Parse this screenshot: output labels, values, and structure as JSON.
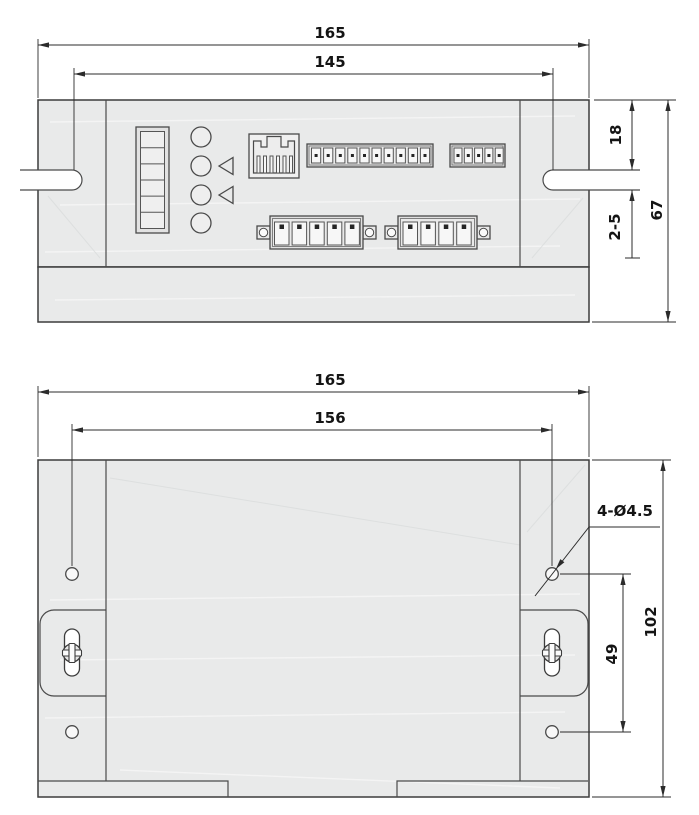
{
  "front_view": {
    "dims": {
      "overall_width": "165",
      "slot_spacing": "145",
      "top_to_slot": "18",
      "panel_thickness": "2-5",
      "overall_height": "67"
    },
    "components": {
      "dip_switch_positions": 6,
      "led_count": 4,
      "indicator_arrows": 2,
      "rj45_port": "RJ45 communication port",
      "terminal_rows_top_positions": [
        10,
        5
      ],
      "terminal_rows_bottom_positions": [
        5,
        4
      ]
    }
  },
  "top_view": {
    "dims": {
      "overall_width": "165",
      "hole_spacing_h": "156",
      "hole_callout": "4-Ø4.5",
      "hole_spacing_v": "49",
      "overall_height": "102"
    },
    "features": {
      "mounting_holes": 4,
      "mounting_screw_slots": 2
    }
  },
  "colors": {
    "body_fill": "#e9eaea",
    "line": "#3c3c3c",
    "dimension_line": "#2b2b2b",
    "background": "#ffffff"
  }
}
